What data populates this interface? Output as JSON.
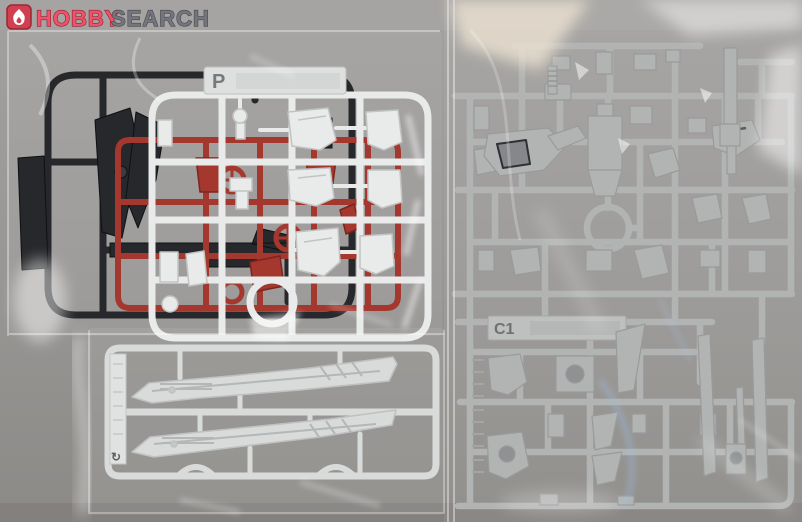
{
  "photo": {
    "subject": "Plastic model kit runners (sprues) sealed in clear plastic bags - product photo",
    "background_color": "#9a9896",
    "watermark": "HOBBY SEARCH"
  },
  "logo": {
    "icon": "flame-icon",
    "icon_bg": "#d04050",
    "icon_fg": "#ffffff",
    "word1": "HOBBY",
    "word1_fill": "#ee5367",
    "word1_outline": "#8e2137",
    "word2": "SEARCH",
    "word2_fill": "#75757d",
    "word2_outline": "#47474f"
  },
  "runners": {
    "black": {
      "color": "#26282b",
      "bag": "top-left"
    },
    "red": {
      "color": "#a5382e",
      "bag": "top-left"
    },
    "white_p": {
      "color": "#e9eaea",
      "tag": "P",
      "bag": "top-left"
    },
    "blades": {
      "color": "#d9dbda",
      "tag_glyph": "↻",
      "bag": "bottom-left"
    },
    "gray_c1": {
      "color": "#b2b4b3",
      "tag": "C1",
      "bag": "right"
    }
  }
}
